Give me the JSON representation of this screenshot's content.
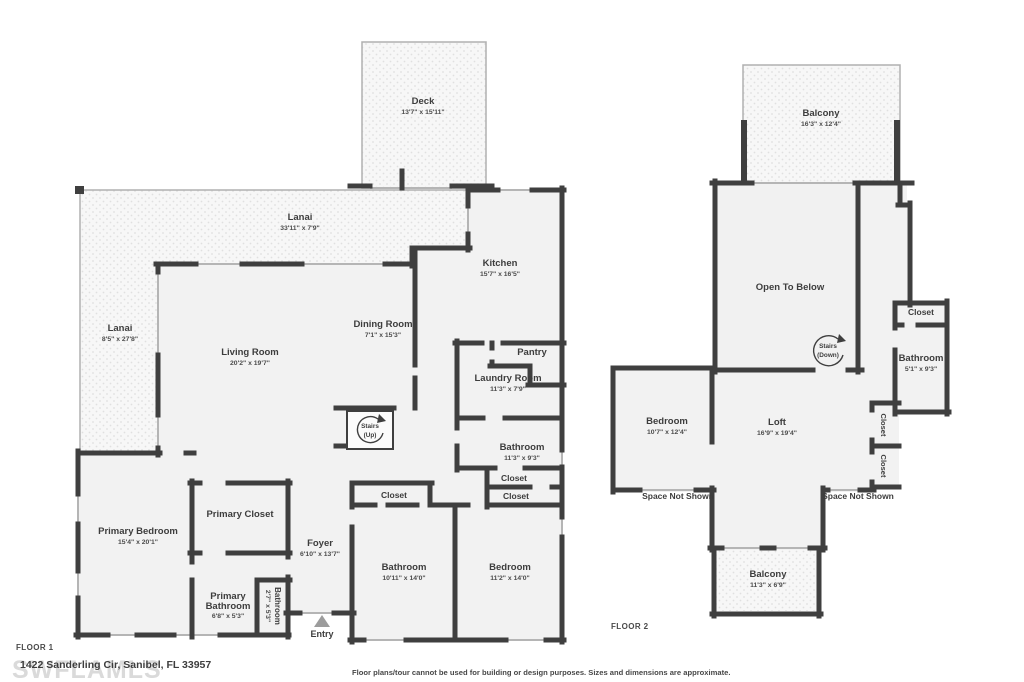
{
  "page": {
    "watermark": "SWFLAMLS",
    "address": "1422 Sanderling Cir, Sanibel, FL 33957",
    "disclaimer": "Floor plans/tour cannot be used for building or design purposes. Sizes and dimensions are approximate."
  },
  "colors": {
    "wall": "#3f3f3f",
    "room_fill": "#f2f2f2",
    "hatch_fill": "#f7f7f7",
    "hatch_dot": "#e0e0e0",
    "window": "#b5b5b5",
    "thin_border": "#b0b0b0",
    "label": "#3d3d3d",
    "watermark": "#dadada"
  },
  "floor1": {
    "title": "FLOOR 1",
    "rooms": {
      "deck": {
        "name": "Deck",
        "dims": "13'7\" x 15'11\""
      },
      "lanai_top": {
        "name": "Lanai",
        "dims": "33'11\" x 7'9\""
      },
      "lanai_left": {
        "name": "Lanai",
        "dims": "8'5\" x 27'8\""
      },
      "kitchen": {
        "name": "Kitchen",
        "dims": "15'7\" x 16'5\""
      },
      "living": {
        "name": "Living Room",
        "dims": "20'2\" x 19'7\""
      },
      "dining": {
        "name": "Dining Room",
        "dims": "7'1\" x 15'3\""
      },
      "pantry": {
        "name": "Pantry"
      },
      "laundry": {
        "name": "Laundry Room",
        "dims": "11'3\" x 7'9\""
      },
      "stairs": {
        "line1": "Stairs",
        "line2": "(Up)"
      },
      "bathroom_hall": {
        "name": "Bathroom",
        "dims": "11'3\" x 9'3\""
      },
      "closet_a": {
        "name": "Closet"
      },
      "closet_b": {
        "name": "Closet"
      },
      "closet_c": {
        "name": "Closet"
      },
      "primary_closet": {
        "name": "Primary Closet"
      },
      "primary_bedroom": {
        "name": "Primary Bedroom",
        "dims": "15'4\" x 20'1\""
      },
      "foyer": {
        "name": "Foyer",
        "dims": "6'10\" x 13'7\""
      },
      "bathroom_big": {
        "name": "Bathroom",
        "dims": "10'11\" x 14'0\""
      },
      "bedroom": {
        "name": "Bedroom",
        "dims": "11'2\" x 14'0\""
      },
      "primary_bathroom": {
        "line1": "Primary",
        "line2": "Bathroom",
        "dims": "6'8\" x 5'3\""
      },
      "bathroom_small": {
        "name": "Bathroom",
        "dims": "2'7\" x 5'3\""
      },
      "entry": {
        "name": "Entry"
      }
    }
  },
  "floor2": {
    "title": "FLOOR 2",
    "rooms": {
      "balcony_top": {
        "name": "Balcony",
        "dims": "16'3\" x 12'4\""
      },
      "open_to_below": {
        "name": "Open To Below"
      },
      "stairs": {
        "line1": "Stairs",
        "line2": "(Down)"
      },
      "closet_top": {
        "name": "Closet"
      },
      "bathroom": {
        "name": "Bathroom",
        "dims": "5'1\" x 9'3\""
      },
      "bedroom": {
        "name": "Bedroom",
        "dims": "10'7\" x 12'4\""
      },
      "loft": {
        "name": "Loft",
        "dims": "16'9\" x 19'4\""
      },
      "closet_mid": {
        "name": "Closet"
      },
      "closet_bottom": {
        "name": "Closet"
      },
      "space_left": {
        "name": "Space Not Shown"
      },
      "space_right": {
        "name": "Space Not Shown"
      },
      "balcony_bottom": {
        "name": "Balcony",
        "dims": "11'3\" x 6'9\""
      }
    }
  }
}
